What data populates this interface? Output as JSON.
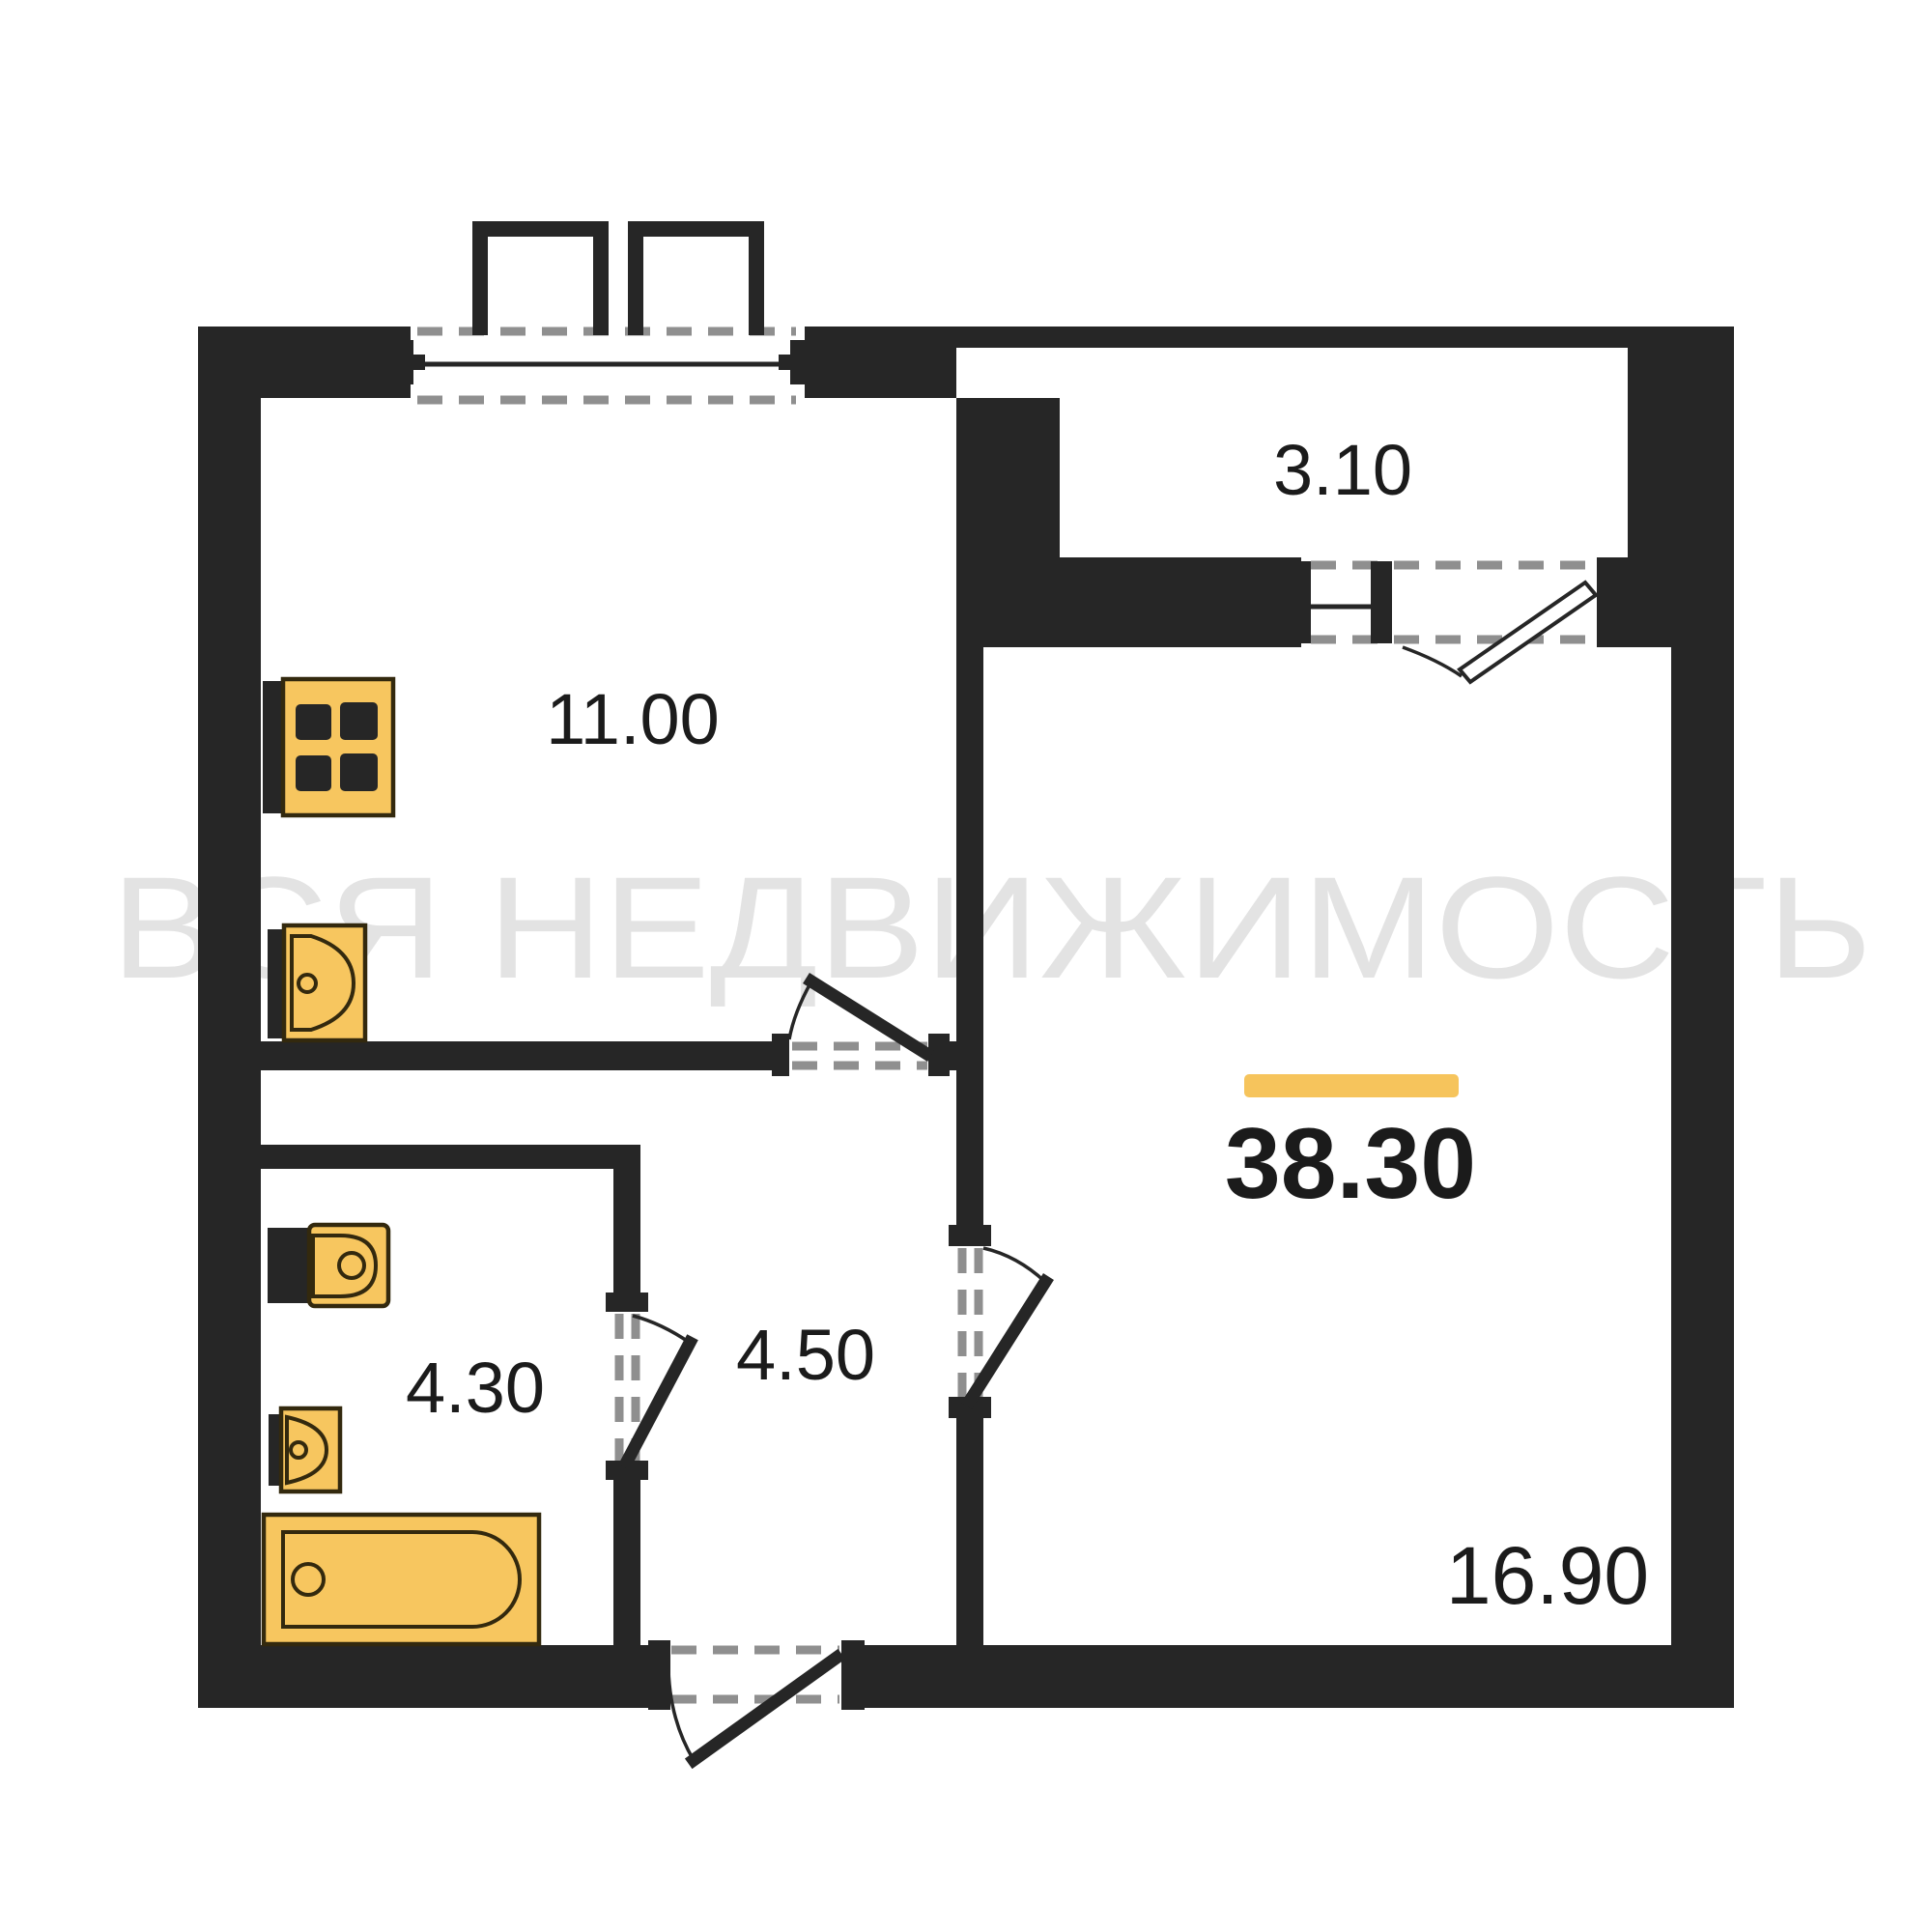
{
  "watermark": "ВСЯ НЕДВИЖИМОСТЬ",
  "rooms": {
    "balcony": {
      "area": "3.10"
    },
    "kitchen": {
      "area": "11.00"
    },
    "total": {
      "area": "38.30"
    },
    "hallway": {
      "area": "4.50"
    },
    "bathroom": {
      "area": "4.30"
    },
    "living": {
      "area": "16.90"
    }
  },
  "colors": {
    "background": "#FFFFFF",
    "wall": "#262626",
    "dash": "#8F8F8F",
    "fixture_fill": "#F7C65F",
    "fixture_stroke": "#33290E",
    "accent_bar": "#F6C45C",
    "watermark": "#E3E3E3"
  }
}
